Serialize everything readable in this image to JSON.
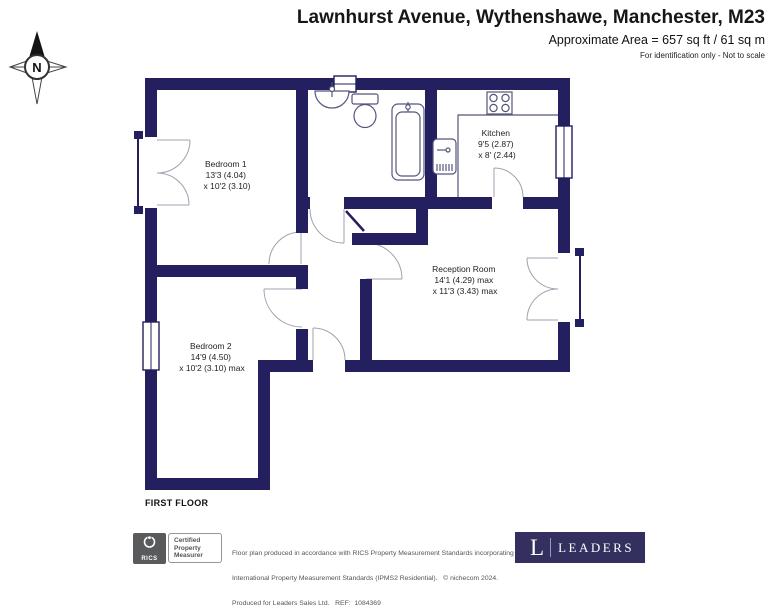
{
  "header": {
    "title": "Lawnhurst Avenue, Wythenshawe, Manchester, M23",
    "area": "Approximate Area = 657 sq ft / 61 sq m",
    "disclaimer": "For identification only - Not to scale"
  },
  "compass": {
    "north_label": "N"
  },
  "floor_label": "FIRST FLOOR",
  "rooms": [
    {
      "name": "Bedroom 1",
      "dim1": "13'3 (4.04)",
      "dim2": "x 10'2 (3.10)"
    },
    {
      "name": "Bedroom 2",
      "dim1": "14'9 (4.50)",
      "dim2": "x 10'2 (3.10) max"
    },
    {
      "name": "Kitchen",
      "dim1": "9'5 (2.87)",
      "dim2": "x 8' (2.44)"
    },
    {
      "name": "Reception Room",
      "dim1": "14'1 (4.29) max",
      "dim2": "x 11'3 (3.43) max"
    }
  ],
  "footer": {
    "rics_badge": {
      "org": "RICS",
      "line1": "Certified",
      "line2": "Property",
      "line3": "Measurer"
    },
    "disclaimer_line1": "Floor plan produced in accordance with RICS Property Measurement Standards incorporating",
    "disclaimer_line2": "International Property Measurement Standards (IPMS2 Residential).   © nichecom 2024.",
    "disclaimer_line3": "Produced for Leaders Sales Ltd.   REF:  1084369",
    "leaders_logo": {
      "initial": "L",
      "name": "LEADERS"
    }
  },
  "colors": {
    "wall_navy": "#241f5e",
    "leaders_navy": "#33305f",
    "rics_gray": "#595a5c"
  }
}
